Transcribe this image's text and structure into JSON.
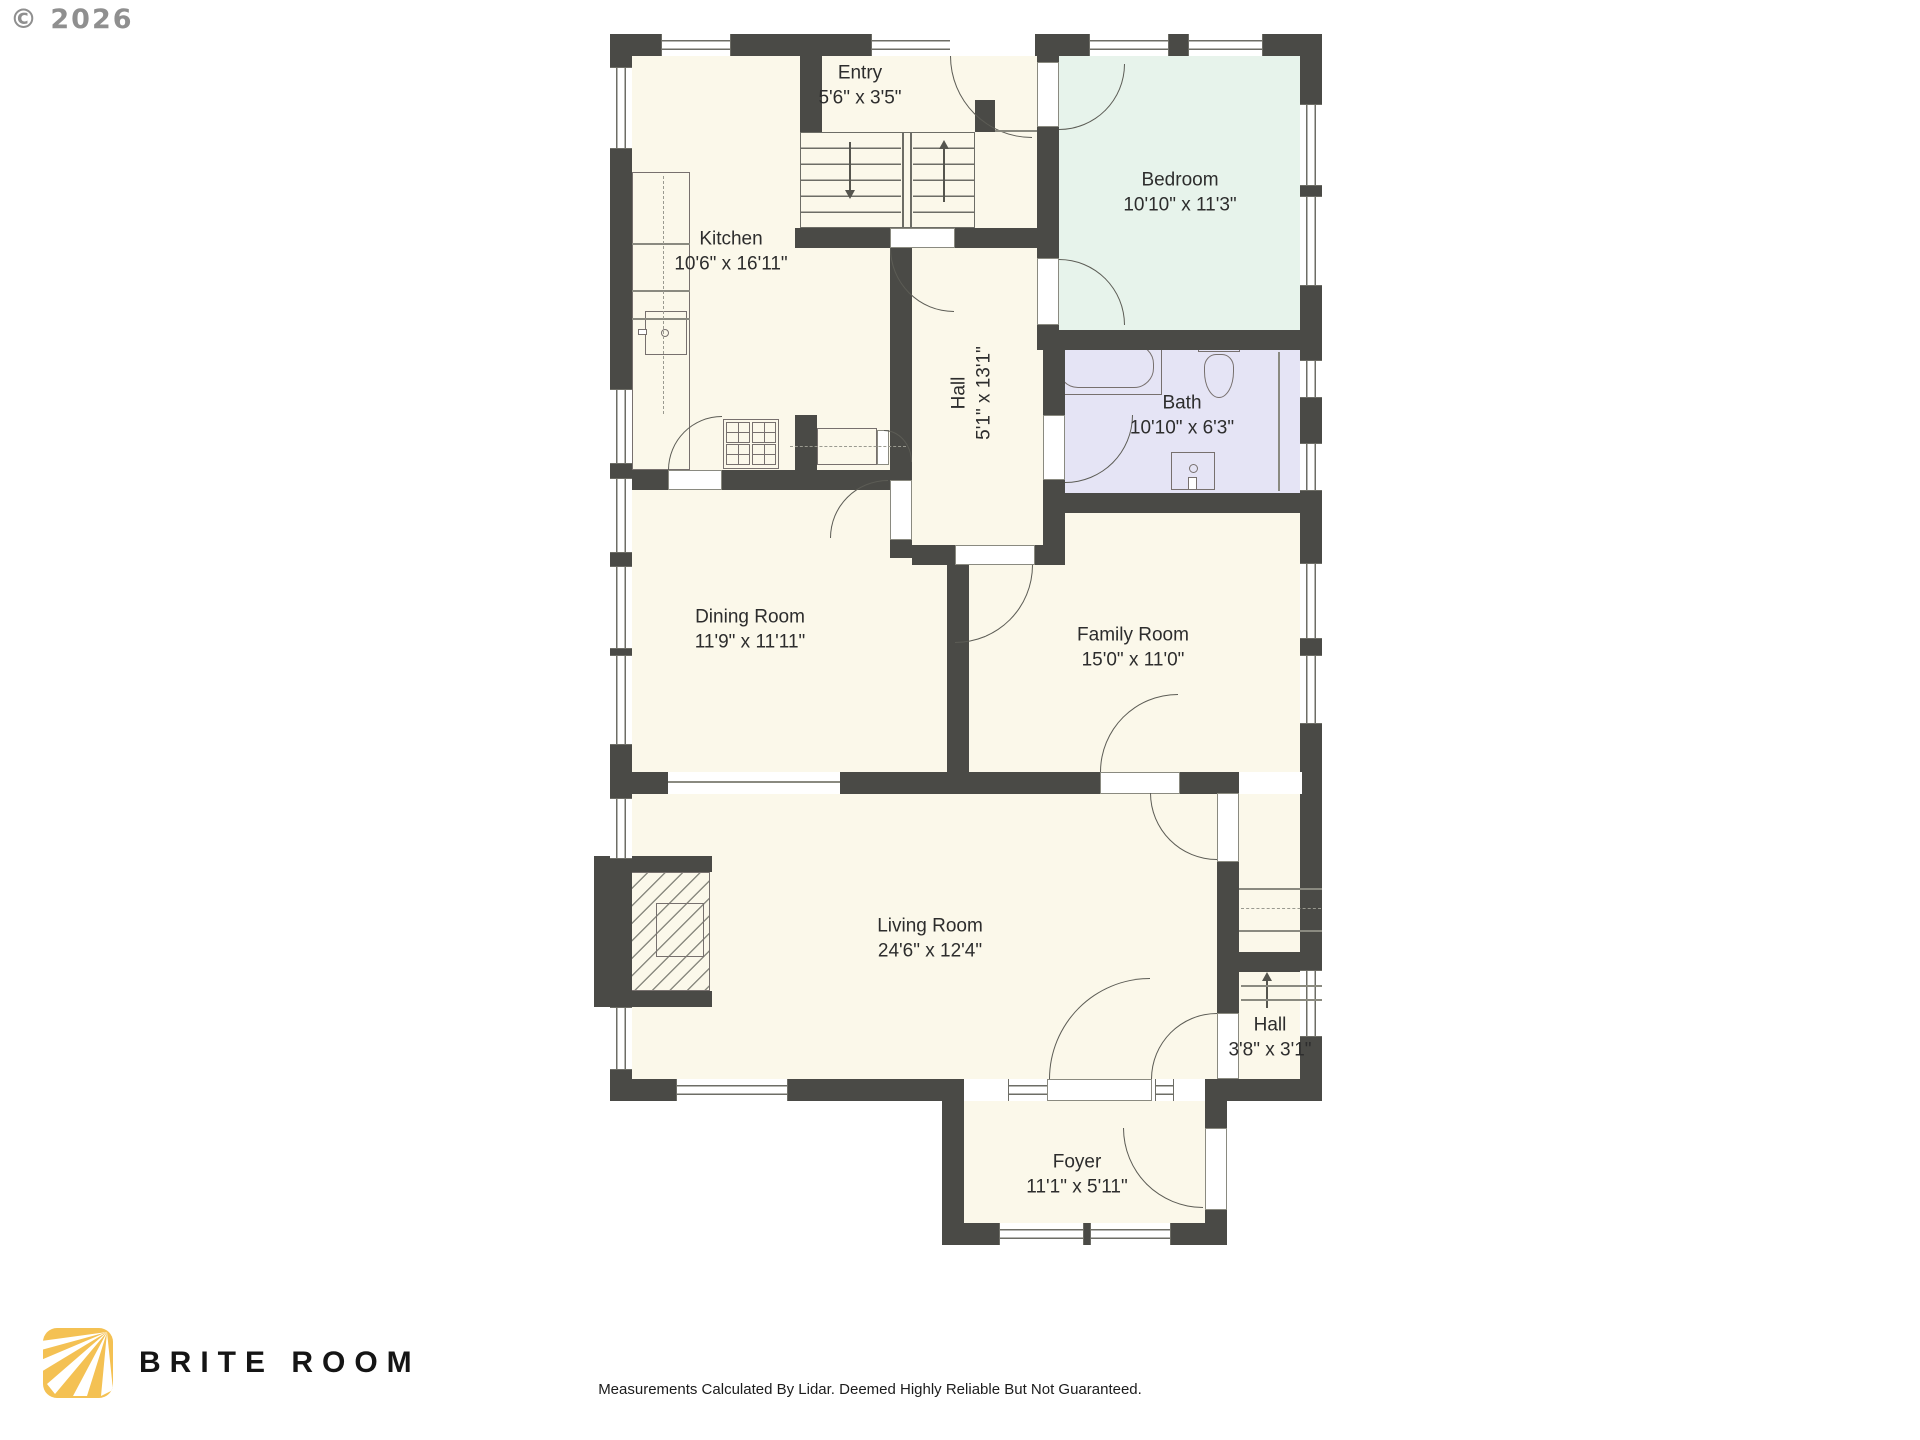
{
  "page": {
    "copyright": "© 2026",
    "disclaimer": "Measurements Calculated By Lidar. Deemed Highly Reliable But Not Guaranteed."
  },
  "brand": {
    "name": "BRITE ROOM"
  },
  "colors": {
    "wall": "#4a4a46",
    "room_cream": "#fbf8ea",
    "bedroom_green": "#e7f3eb",
    "bath_lavender": "#e5e4f5",
    "logo_yellow": "#f4c153"
  },
  "rooms": [
    {
      "id": "entry",
      "name": "Entry",
      "dims": "5'6\" x 3'5\""
    },
    {
      "id": "kitchen",
      "name": "Kitchen",
      "dims": "10'6\" x 16'11\""
    },
    {
      "id": "bedroom",
      "name": "Bedroom",
      "dims": "10'10\" x 11'3\""
    },
    {
      "id": "hall-upper",
      "name": "Hall",
      "dims": "5'1\" x 13'1\""
    },
    {
      "id": "bath",
      "name": "Bath",
      "dims": "10'10\" x 6'3\""
    },
    {
      "id": "dining-room",
      "name": "Dining Room",
      "dims": "11'9\" x 11'11\""
    },
    {
      "id": "family-room",
      "name": "Family Room",
      "dims": "15'0\" x 11'0\""
    },
    {
      "id": "living-room",
      "name": "Living Room",
      "dims": "24'6\" x 12'4\""
    },
    {
      "id": "hall-lower",
      "name": "Hall",
      "dims": "3'8\" x 3'1\""
    },
    {
      "id": "foyer",
      "name": "Foyer",
      "dims": "11'1\" x 5'11\""
    }
  ]
}
